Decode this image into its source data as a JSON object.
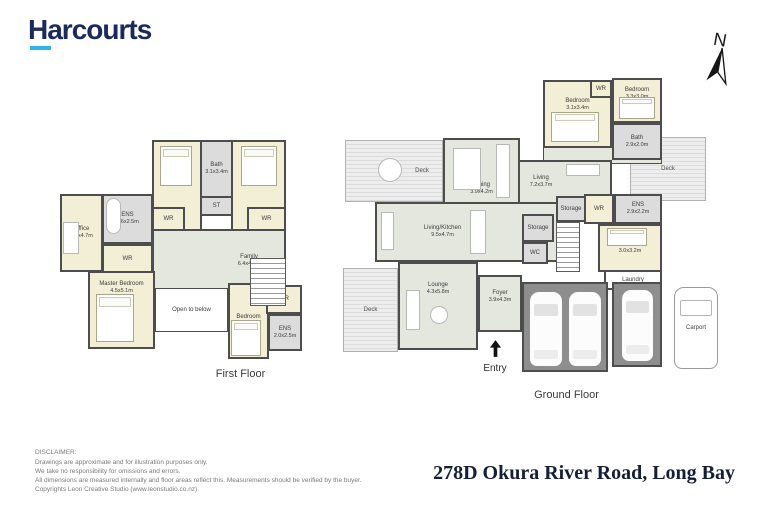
{
  "brand": {
    "logo_text": "Harcourts",
    "navy_color": "#1b2a5b",
    "accent_color": "#35b2e5"
  },
  "compass": {
    "label": "N"
  },
  "floors": {
    "first": {
      "title": "First Floor",
      "rooms": {
        "bedroom1": {
          "name": "Bedroom",
          "dims": "3.2x4.7m"
        },
        "bath": {
          "name": "Bath",
          "dims": "3.1x3.4m"
        },
        "bedroom2": {
          "name": "Bedroom",
          "dims": "3.2x4.7m"
        },
        "wr1": {
          "name": "WR"
        },
        "st": {
          "name": "ST"
        },
        "wr2": {
          "name": "WR"
        },
        "ens1": {
          "name": "ENS",
          "dims": "3.6x2.5m"
        },
        "office": {
          "name": "Office",
          "dims": "2.6x4.7m"
        },
        "wr3": {
          "name": "WR"
        },
        "family": {
          "name": "Family",
          "dims": "6.4x4.4m"
        },
        "master": {
          "name": "Master Bedroom",
          "dims": "4.5x5.1m"
        },
        "open_below": {
          "name": "Open to below"
        },
        "bedroom3": {
          "name": "Bedroom",
          "dims": "3.5x4.8m"
        },
        "wr4": {
          "name": "WR"
        },
        "ens2": {
          "name": "ENS",
          "dims": "2.0x2.5m"
        }
      }
    },
    "ground": {
      "title": "Ground Floor",
      "entry_label": "Entry",
      "rooms": {
        "deck_top": {
          "name": "Deck"
        },
        "dining": {
          "name": "Dining",
          "dims": "3.9x4.2m"
        },
        "bedroom1": {
          "name": "Bedroom",
          "dims": "3.1x3.4m"
        },
        "wr1": {
          "name": "WR"
        },
        "bedroom2": {
          "name": "Bedroom",
          "dims": "3.3x3.0m"
        },
        "bath": {
          "name": "Bath",
          "dims": "2.9x2.0m"
        },
        "living": {
          "name": "Living",
          "dims": "7.2x3.7m"
        },
        "deck_right": {
          "name": "Deck"
        },
        "living_kitchen": {
          "name": "Living/Kitchen",
          "dims": "9.5x4.7m"
        },
        "storage1": {
          "name": "Storage"
        },
        "storage2": {
          "name": "Storage"
        },
        "wr2": {
          "name": "WR"
        },
        "ens": {
          "name": "ENS",
          "dims": "2.9x2.2m"
        },
        "bedroom3": {
          "name": "Bedroom",
          "dims": "3.0x3.2m"
        },
        "wc": {
          "name": "WC"
        },
        "deck_bottom": {
          "name": "Deck"
        },
        "lounge": {
          "name": "Lounge",
          "dims": "4.3x5.8m"
        },
        "foyer": {
          "name": "Foyer",
          "dims": "3.9x4.3m"
        },
        "laundry": {
          "name": "Laundry"
        },
        "garage1": {
          "name": "Garage",
          "dims": "6.0x6.2m"
        },
        "garage2": {
          "name": "Garage",
          "dims": "3.2x6.1m"
        },
        "carport": {
          "name": "Carport"
        }
      }
    }
  },
  "footer": {
    "disclaimer_title": "DISCLAIMER:",
    "disclaimer_lines": [
      "Drawings are approximate and for illustration purposes only.",
      "We take no responsibility for omissions and errors.",
      "All dimensions are measured internally and floor areas reflect this. Measurements should be verified by the buyer.",
      "Copyrights Leon Creative Studio (www.leonstudio.co.nz)"
    ],
    "address": "278D Okura River Road, Long Bay"
  }
}
